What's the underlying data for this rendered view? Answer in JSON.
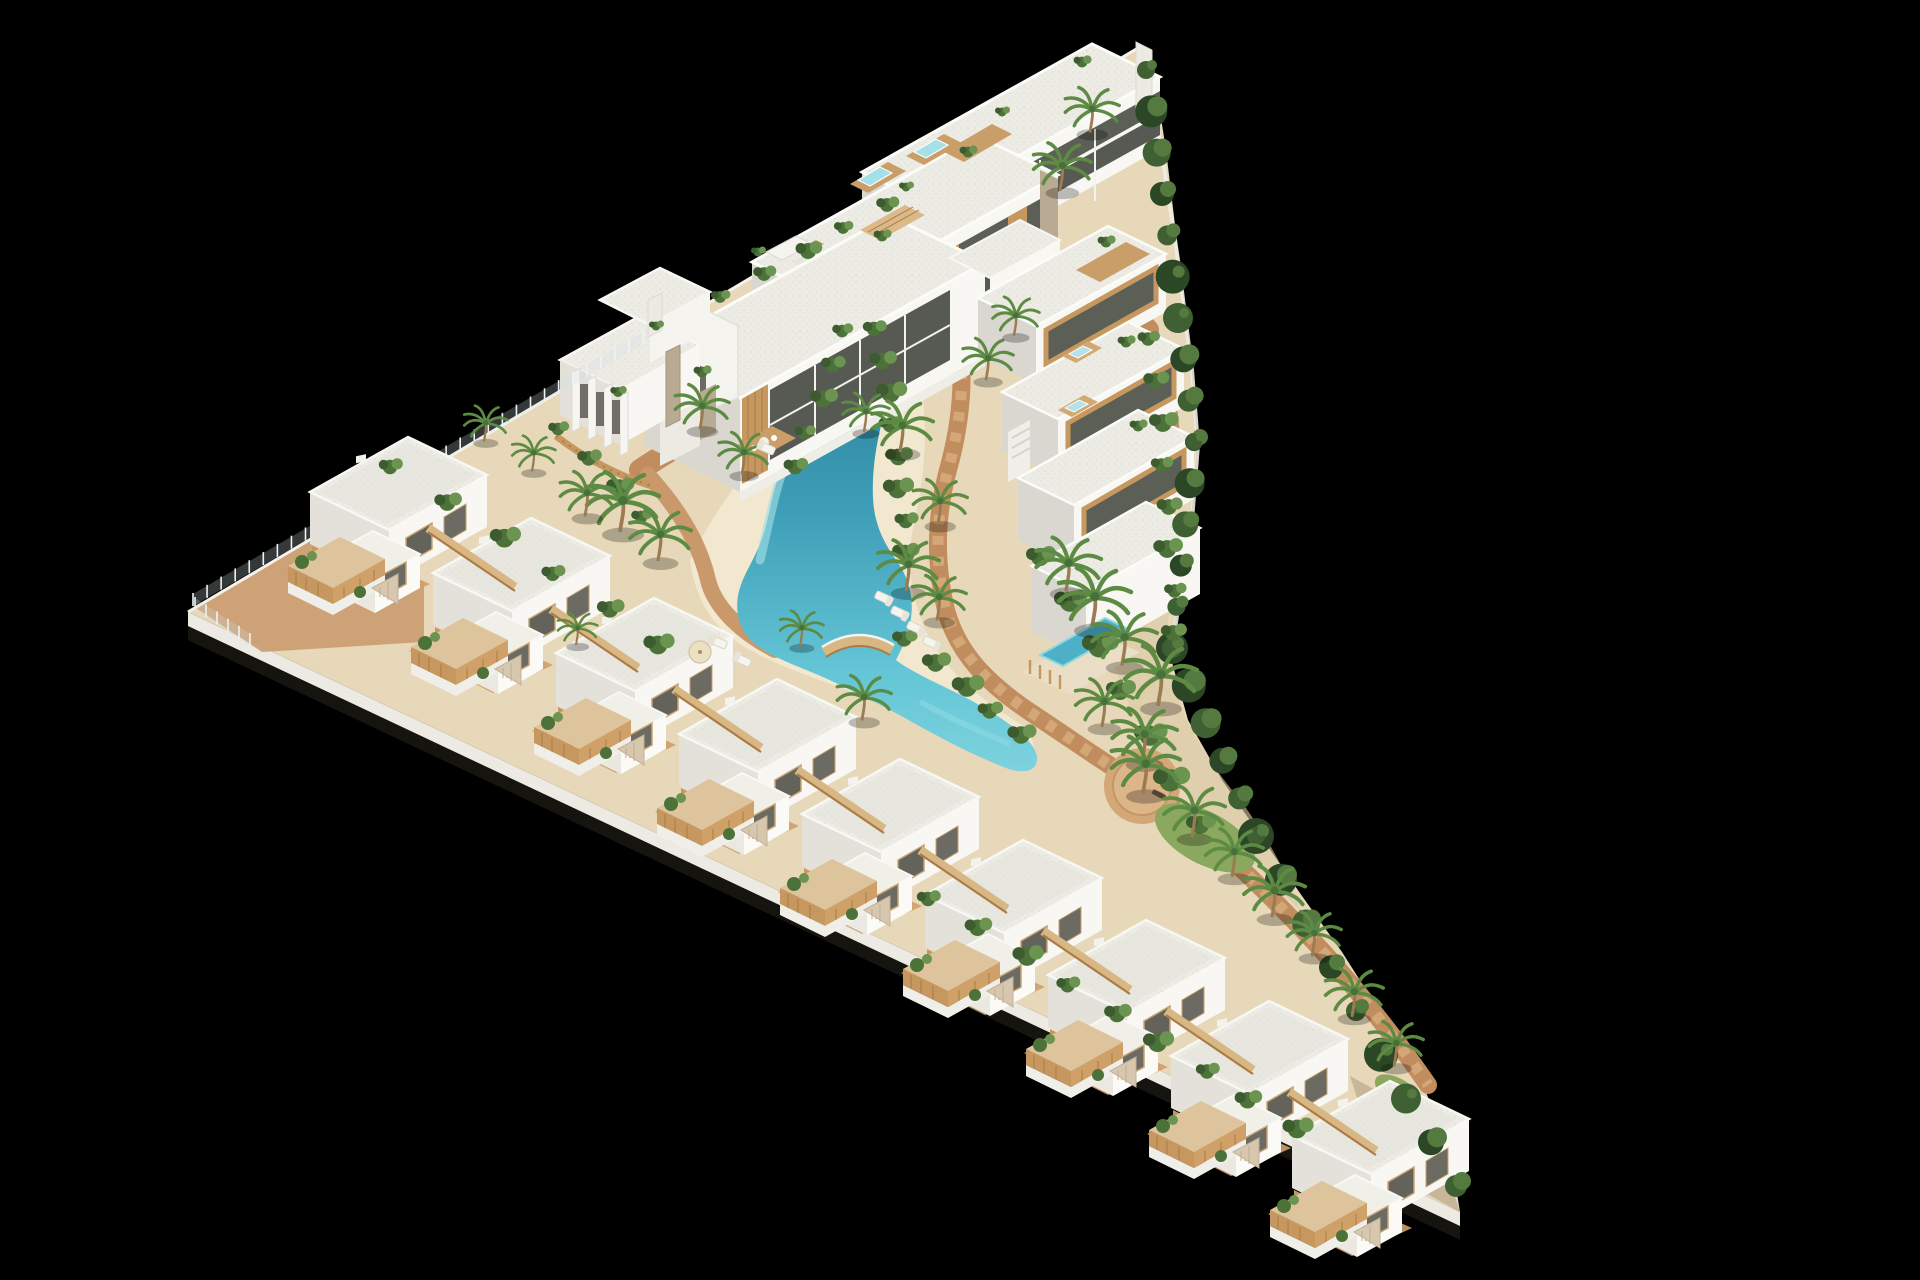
{
  "meta": {
    "title": "Residential development aerial 3D render",
    "description": "Aerial 3D architectural render of a triangular Mediterranean residential complex on a black background: white flat-roofed apartment blocks along the top edge with rooftop plunge pools and wood decks, a stepped row of nine white villas with wooden terraces along the lower edge, a winding turquoise lagoon pool with sandy beach, palm trees, hedges along the curved right boundary, boardwalks and a round plaza.",
    "type": "architectural-render",
    "visible_text": []
  },
  "canvas": {
    "width": 1920,
    "height": 1280,
    "background": "#000000"
  },
  "palette": {
    "background": "#000000",
    "sand": "#e7d8b9",
    "sand_bright": "#f2e8d0",
    "terracotta": "#c28d5e",
    "terracotta_light": "#d3a777",
    "stone": "#d8cbb4",
    "facade_white": "#f8f7f3",
    "roof": "#ecebe4",
    "facade_shade": "#e2e0d8",
    "facade_dark": "#c8c6be",
    "glass": "#5b5f56",
    "wood": "#c6985f",
    "wood_light": "#dcb988",
    "wood_dark": "#a87b47",
    "pool_deep": "#23788f",
    "pool_mid": "#3f9fb8",
    "pool_bright": "#64c6d6",
    "pool_pale": "#a5dfe8",
    "hedge": "#2c4725",
    "green": "#4c7239",
    "green_light": "#6b9450",
    "palm": "#5d8b44",
    "grass": "#8aa85e",
    "trunk": "#9a7b52"
  },
  "objects": {
    "villas": [
      [
        310,
        492
      ],
      [
        433,
        573
      ],
      [
        556,
        653
      ],
      [
        679,
        734
      ],
      [
        802,
        814
      ],
      [
        925,
        895
      ],
      [
        1048,
        975
      ],
      [
        1171,
        1056
      ],
      [
        1292,
        1136
      ]
    ],
    "beam_offsets": {
      "from": [
        118,
        36
      ],
      "to": [
        205,
        95
      ]
    },
    "palms": [
      [
        620,
        526,
        1.0
      ],
      [
        585,
        512,
        0.75
      ],
      [
        658,
        556,
        0.85
      ],
      [
        742,
        470,
        0.7
      ],
      [
        700,
        425,
        0.75
      ],
      [
        900,
        447,
        0.85
      ],
      [
        864,
        428,
        0.65
      ],
      [
        938,
        520,
        0.75
      ],
      [
        906,
        586,
        0.85
      ],
      [
        937,
        616,
        0.75
      ],
      [
        800,
        643,
        0.6
      ],
      [
        862,
        716,
        0.75
      ],
      [
        1066,
        586,
        0.9
      ],
      [
        1092,
        622,
        1.0
      ],
      [
        1122,
        660,
        0.9
      ],
      [
        1158,
        700,
        1.0
      ],
      [
        1102,
        722,
        0.8
      ],
      [
        1142,
        757,
        0.9
      ],
      [
        1143,
        788,
        0.95
      ],
      [
        1192,
        832,
        0.85
      ],
      [
        1232,
        872,
        0.8
      ],
      [
        1272,
        912,
        0.85
      ],
      [
        1312,
        952,
        0.75
      ],
      [
        1352,
        1012,
        0.8
      ],
      [
        1394,
        1062,
        0.75
      ],
      [
        986,
        376,
        0.7
      ],
      [
        1014,
        332,
        0.65
      ],
      [
        1060,
        186,
        0.8
      ],
      [
        1090,
        128,
        0.75
      ],
      [
        484,
        438,
        0.6
      ],
      [
        532,
        468,
        0.6
      ],
      [
        576,
        642,
        0.55
      ]
    ],
    "shrub_bands": [
      [
        878,
        332,
        908,
        556,
        8,
        0.8
      ],
      [
        846,
        334,
        792,
        470,
        5,
        0.7
      ],
      [
        908,
        642,
        1018,
        738,
        5,
        0.85
      ],
      [
        1044,
        560,
        1198,
        828,
        7,
        1.0
      ],
      [
        1152,
        342,
        1176,
        636,
        8,
        0.75
      ],
      [
        394,
        470,
        660,
        648,
        6,
        0.8
      ],
      [
        932,
        902,
        1296,
        1132,
        9,
        0.8
      ],
      [
        724,
        300,
        884,
        208,
        5,
        0.65
      ],
      [
        562,
        432,
        642,
        520,
        4,
        0.7
      ]
    ],
    "shrubs": [
      [
        1082,
        62,
        0.6
      ],
      [
        1002,
        112,
        0.5
      ],
      [
        968,
        152,
        0.6
      ],
      [
        906,
        187,
        0.5
      ],
      [
        882,
        236,
        0.6
      ],
      [
        702,
        372,
        0.6
      ],
      [
        1106,
        242,
        0.6
      ],
      [
        1126,
        342,
        0.6
      ],
      [
        1138,
        426,
        0.6
      ],
      [
        656,
        326,
        0.5
      ],
      [
        618,
        392,
        0.55
      ],
      [
        758,
        252,
        0.5
      ]
    ],
    "hedge_bands": [
      [
        1146,
        70,
        1194,
        442,
        10,
        13
      ],
      [
        1194,
        442,
        1172,
        648,
        6,
        12
      ],
      [
        1172,
        648,
        1256,
        836,
        6,
        14
      ],
      [
        1256,
        836,
        1456,
        1186,
        9,
        13
      ]
    ],
    "fence_segments": [
      {
        "x1": 193,
        "y1": 606,
        "x2": 643,
        "y2": 344,
        "n": 33,
        "dark": false
      },
      {
        "x1": 195,
        "y1": 610,
        "x2": 250,
        "y2": 646,
        "n": 6,
        "dark": false
      },
      {
        "x1": 1436,
        "y1": 1128,
        "x2": 1460,
        "y2": 1176,
        "n": 5,
        "dark": true
      }
    ],
    "loungers": [
      [
        718,
        642,
        24
      ],
      [
        742,
        660,
        24
      ],
      [
        884,
        598,
        205
      ],
      [
        900,
        613,
        205
      ],
      [
        916,
        628,
        205
      ],
      [
        932,
        643,
        205
      ],
      [
        766,
        448,
        24
      ]
    ],
    "rooftop_pools": [
      [
        850,
        184
      ],
      [
        906,
        156
      ]
    ],
    "jacuzzis": [
      [
        1062,
        356
      ],
      [
        1058,
        410
      ]
    ]
  }
}
